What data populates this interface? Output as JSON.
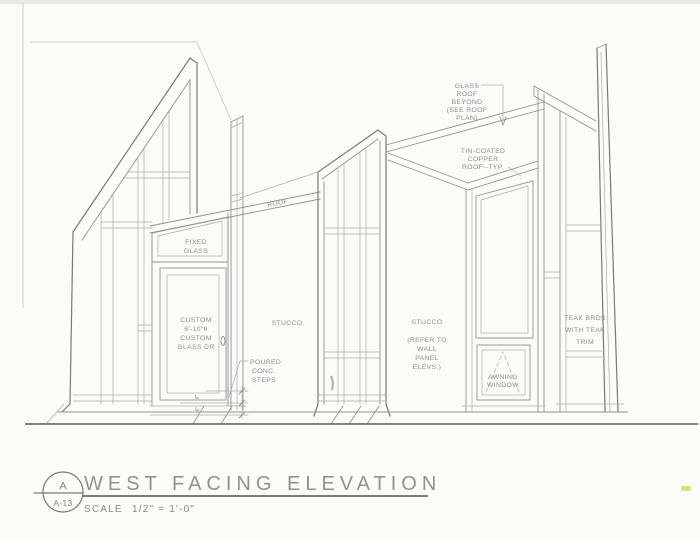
{
  "page": {
    "background": "#fbfbf8",
    "pencil_color": "#8f948f",
    "dark_line_color": "#767b76",
    "text_color": "#8a8f8c",
    "scan_artifact_color": "#d4da64"
  },
  "title_block": {
    "detail_letter": "A",
    "sheet_number": "A-13",
    "title": "WEST FACING ELEVATION",
    "scale_label": "SCALE",
    "scale_value": "1/2\" = 1'-0\""
  },
  "labels": {
    "glass_roof_beyond": [
      "GLASS",
      "ROOF",
      "BEYOND",
      "(SEE ROOF",
      "PLAN)"
    ],
    "copper_roof": [
      "TIN-COATED",
      "COPPER",
      "ROOF--TYP."
    ],
    "roof": "ROOF",
    "fixed_glass": [
      "FIXED",
      "GLASS"
    ],
    "custom_door": [
      "CUSTOM",
      "6'-10\"h",
      "CUSTOM",
      "GLASS DR"
    ],
    "stucco_left": "STUCCO",
    "poured_steps": [
      "POURED",
      "CONC.",
      "STEPS"
    ],
    "stucco_right": [
      "STUCCO",
      "(REFER TO",
      "WALL",
      "PANEL",
      "ELEVS.)"
    ],
    "awning_window": [
      "AWNING",
      "WINDOW"
    ],
    "teak_boards": [
      "TEAK BRDS",
      "WITH TEAK",
      "TRIM"
    ],
    "step_riser_dims": [
      "6\"",
      "6\""
    ]
  }
}
